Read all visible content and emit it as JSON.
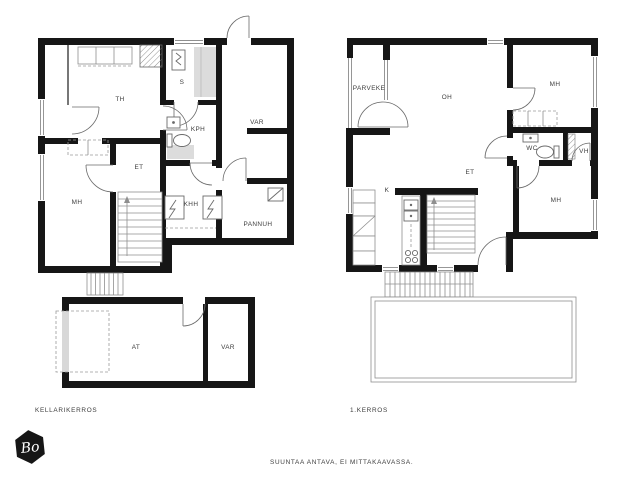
{
  "page": {
    "background": "#ffffff"
  },
  "colors": {
    "wall": "#161616",
    "thin_line": "#8f8f8f",
    "fixture_line": "#6a6a6a",
    "shade_gray": "#dcdcdc",
    "garage_door_gray": "#d8d8d8",
    "label_text": "#3c3c3c",
    "logo_bg": "#161616",
    "logo_text_color": "#ffffff"
  },
  "plans": {
    "basement": {
      "caption": "KELLARIKERROS",
      "rooms": [
        "TH",
        "S",
        "KPH",
        "VAR",
        "ET",
        "MH",
        "KHH",
        "PANNUH"
      ],
      "garage_rooms": [
        "AT",
        "VAR"
      ]
    },
    "first_floor": {
      "caption": "1.KERROS",
      "rooms": [
        "PARVEKE",
        "OH",
        "MH",
        "WC",
        "VH",
        "ET",
        "K",
        "MH"
      ]
    }
  },
  "footer": {
    "disclaimer": "SUUNTAA ANTAVA, EI MITTAKAAVASSA."
  },
  "logo": {
    "text": "Bo",
    "shape": "hexagon"
  },
  "icons": {
    "fixtures": [
      "staircase",
      "exterior-steps",
      "door-arc",
      "window",
      "sauna-heater-icon",
      "toilet-icon",
      "sink-icon",
      "washing-machine-icon",
      "dryer-icon",
      "boiler-icon",
      "fireplace-icon",
      "fridge-icon",
      "stove-icon",
      "kitchen-sink-icon",
      "wardrobe",
      "car-space",
      "terrace",
      "hexagon-logo"
    ]
  }
}
